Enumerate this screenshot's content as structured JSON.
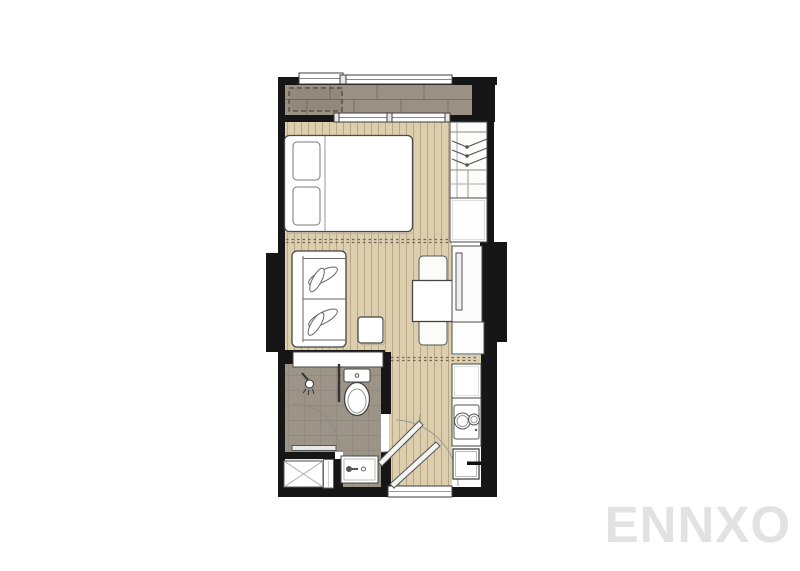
{
  "watermark": {
    "text": "ENNXO",
    "color": "#e2e2e2"
  },
  "plan": {
    "description": "studio condominium floor plan, top-down view, no text labels visible",
    "colors": {
      "background": "#ffffff",
      "wall": "#161616",
      "balcony_floor": "#9a9184",
      "wood_floor": "#ddcfae",
      "bath_floor": "#9d9488",
      "laundry_floor": "#edebe7",
      "furniture_fill": "#ffffff",
      "furniture_stroke": "#4a4a4a",
      "divider_dots": "#6f675a",
      "window_frame": "#3d3d3d"
    },
    "rooms": [
      "balcony",
      "bedroom",
      "living-dining",
      "entrance-hall",
      "kitchenette",
      "bathroom",
      "laundry-nook"
    ],
    "fixtures": [
      "ac-unit-pad",
      "double-bed",
      "pillows",
      "wardrobe-with-hangers",
      "storage-cabinet",
      "sofa-two-seat",
      "side-table",
      "dining-table",
      "dining-chairs",
      "tv-console",
      "sideboard",
      "wall-cabinet",
      "shower-head",
      "shower-screen",
      "toilet",
      "bathroom-sink",
      "washing-machine",
      "kitchen-cabinet",
      "two-burner-stove",
      "refrigerator",
      "entrance-door-leaves",
      "door-swing-arcs",
      "windows"
    ]
  }
}
